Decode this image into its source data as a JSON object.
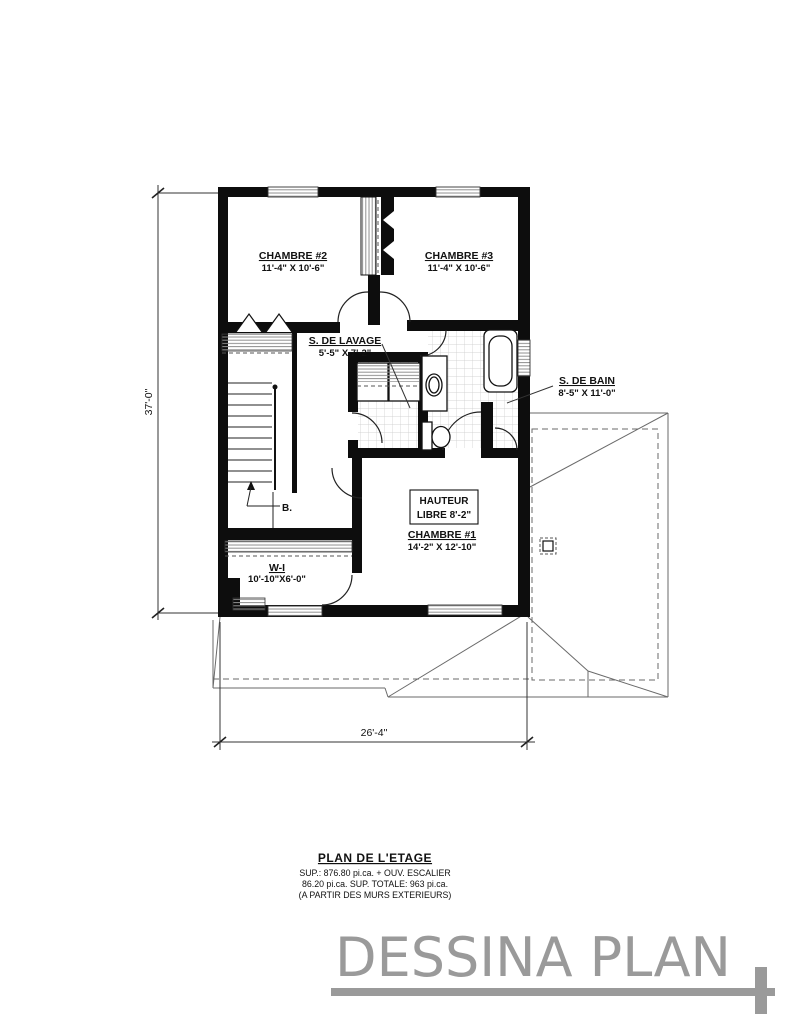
{
  "plan": {
    "dim_height": "37'-0\"",
    "dim_width": "26'-4\"",
    "rooms": {
      "chambre2": {
        "name": "CHAMBRE #2",
        "dims": "11'-4\" X 10'-6\""
      },
      "chambre3": {
        "name": "CHAMBRE #3",
        "dims": "11'-4\" X 10'-6\""
      },
      "lavage": {
        "name": "S. DE LAVAGE",
        "dims": "5'-5\" X 7'-2\""
      },
      "bain": {
        "name": "S. DE BAIN",
        "dims": "8'-5\" X 11'-0\""
      },
      "chambre1": {
        "name": "CHAMBRE #1",
        "dims": "14'-2\" X 12'-10\""
      },
      "walkin": {
        "name": "W-I",
        "dims": "10'-10\"X6'-0\""
      }
    },
    "notes": {
      "hauteur1": "HAUTEUR",
      "hauteur2": "LIBRE 8'-2\"",
      "stairs_down": "B."
    }
  },
  "title_block": {
    "title": "PLAN DE L'ETAGE",
    "line1": "SUP.: 876.80 pi.ca. + OUV. ESCALIER",
    "line2": "86.20 pi.ca. SUP. TOTALE: 963 pi.ca.",
    "line3": "(A PARTIR DES MURS EXTERIEURS)"
  },
  "logo": {
    "text": "DESSINA PLAN"
  }
}
